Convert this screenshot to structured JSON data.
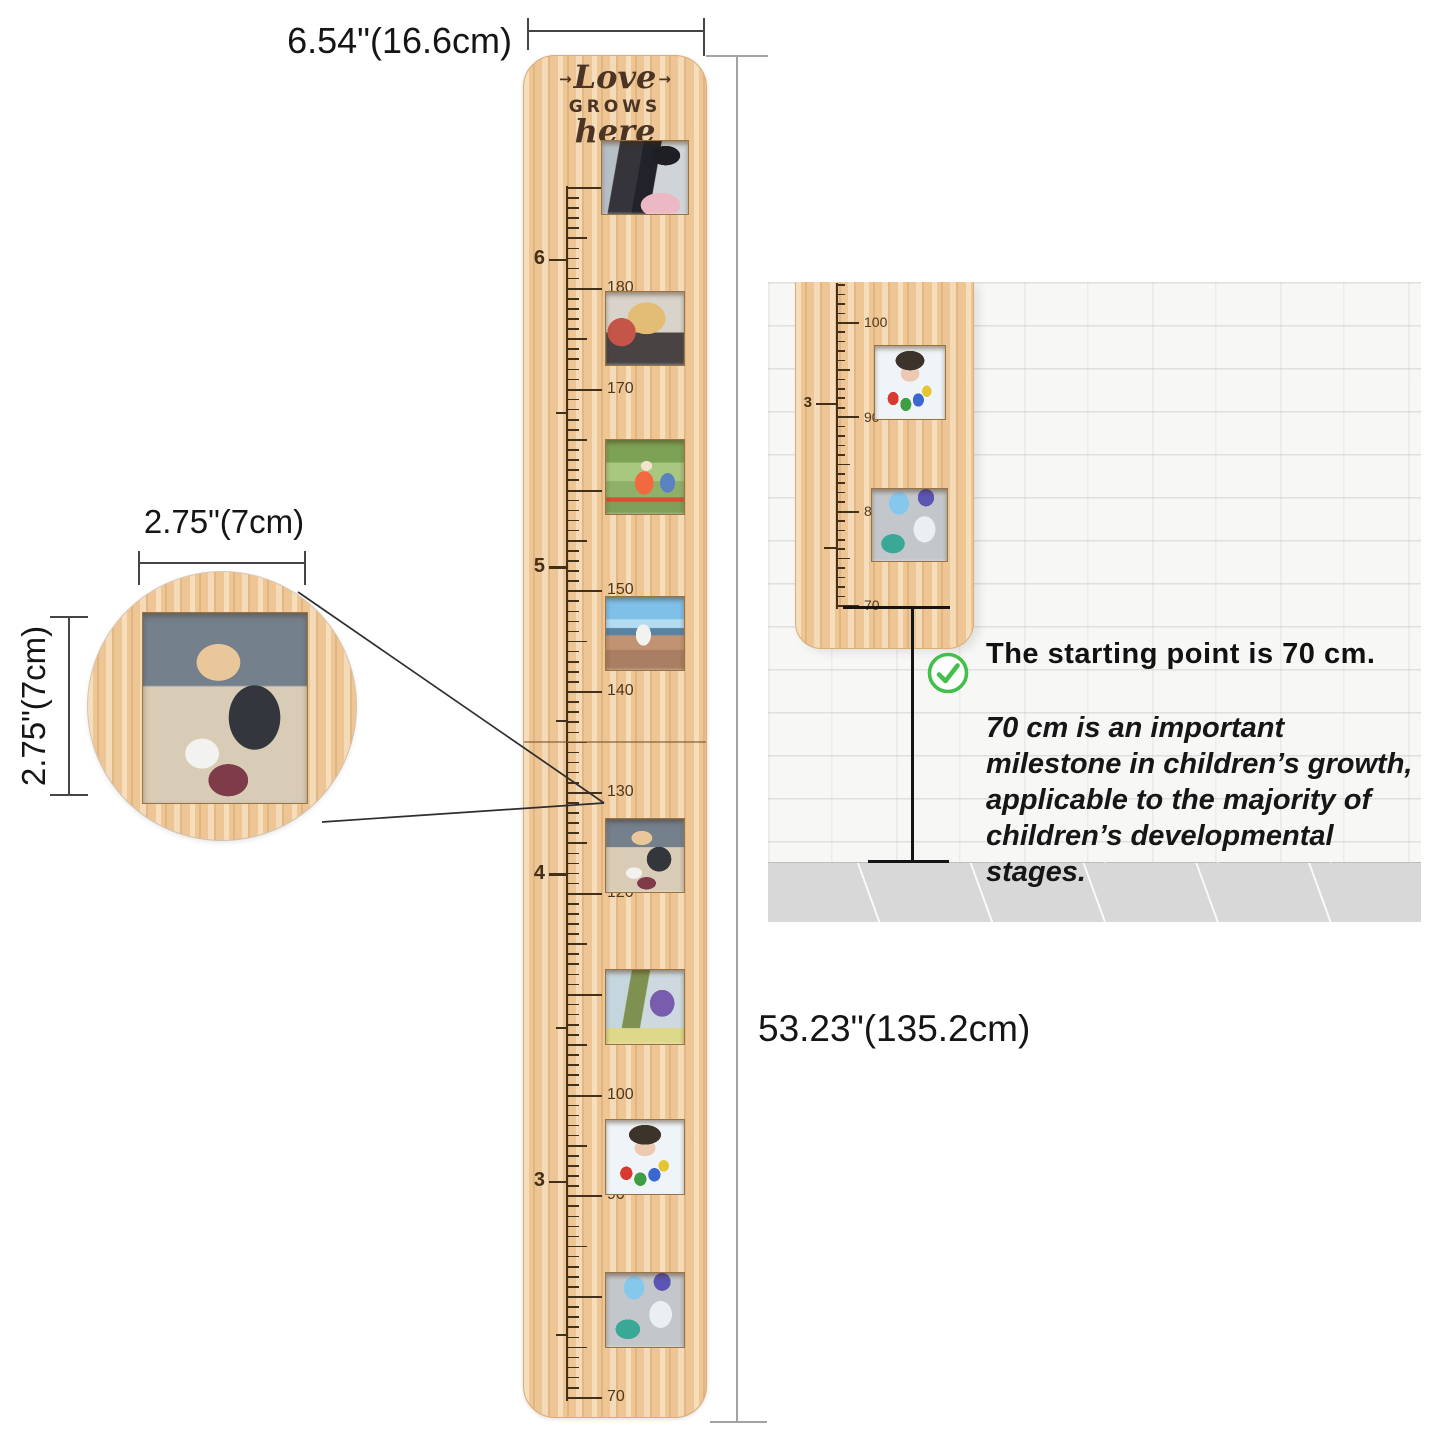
{
  "dimensions": {
    "board_width_label": "6.54\"(16.6cm)",
    "board_height_label": "53.23\"(135.2cm)",
    "frame_width_label": "2.75\"(7cm)",
    "frame_height_label": "2.75\"(7cm)"
  },
  "board": {
    "engraving": {
      "arrow": "→",
      "line1": "Love",
      "line2": "GROWS",
      "line3": "here"
    },
    "ruler": {
      "cm_min": 70,
      "cm_max": 190,
      "cm_labels": [
        "70",
        "80",
        "90",
        "100",
        "110",
        "120",
        "130",
        "140",
        "150",
        "160",
        "170",
        "180",
        "190"
      ],
      "feet_labels": [
        "3",
        "4",
        "5",
        "6"
      ]
    },
    "photos": [
      {
        "name": "graduation-couple-photo"
      },
      {
        "name": "woman-with-cake-photo"
      },
      {
        "name": "race-finish-photo"
      },
      {
        "name": "city-vista-photo"
      },
      {
        "name": "girl-with-soccer-ball-photo"
      },
      {
        "name": "child-with-backpack-photo"
      },
      {
        "name": "painted-hands-photo"
      },
      {
        "name": "birthday-toddler-photo"
      }
    ]
  },
  "inset": {
    "photo": "girl-with-soccer-ball-photo"
  },
  "panel": {
    "headline": "The starting point is 70 cm.",
    "body": "70 cm is an important milestone in children’s growth, applicable to the majority of children’s developmental stages.",
    "mini_ruler": {
      "cm_min": 70,
      "cm_max": 104,
      "cm_labels": [
        "70",
        "80",
        "90",
        "100"
      ],
      "feet_labels": [
        "3"
      ]
    },
    "check_icon_color": "#45bf4c"
  },
  "colors": {
    "wood": "#eec695",
    "engraving": "#4b3423",
    "tick": "#42301a",
    "dim_dark": "#454545",
    "dim_gray": "#a3a3a3",
    "text": "#151515",
    "wall": "#f7f7f6",
    "floor": "#d8d8d9"
  }
}
